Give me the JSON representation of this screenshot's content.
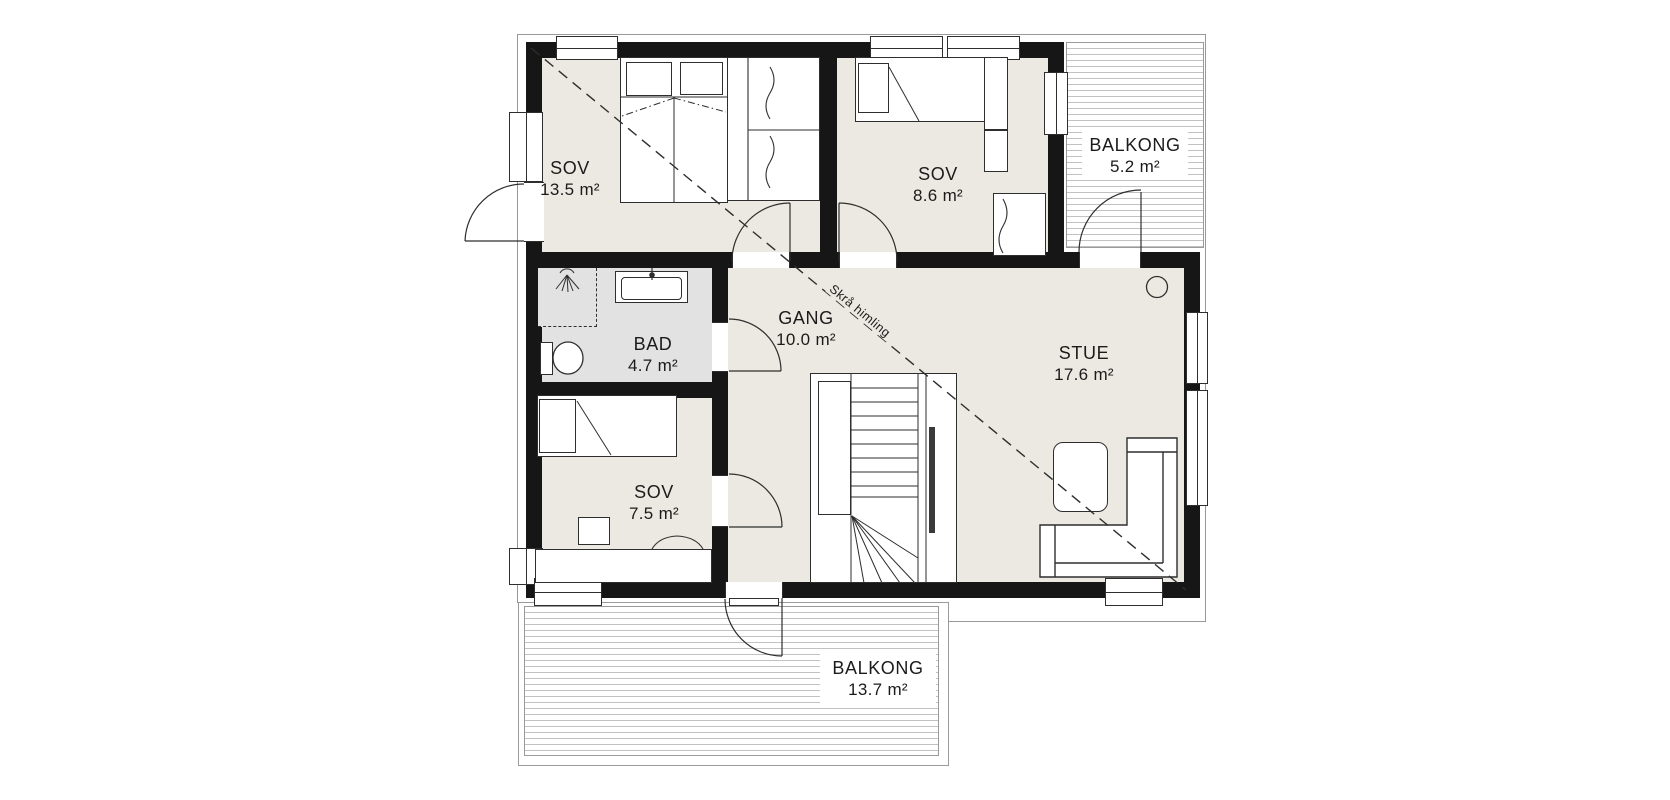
{
  "plan": {
    "title": "floor-plan",
    "rooms": [
      {
        "id": "sov1",
        "name": "SOV",
        "area": "13.5 m²"
      },
      {
        "id": "sov2",
        "name": "SOV",
        "area": "8.6 m²"
      },
      {
        "id": "balkong1",
        "name": "BALKONG",
        "area": "5.2 m²"
      },
      {
        "id": "bad",
        "name": "BAD",
        "area": "4.7 m²"
      },
      {
        "id": "gang",
        "name": "GANG",
        "area": "10.0 m²"
      },
      {
        "id": "stue",
        "name": "STUE",
        "area": "17.6 m²"
      },
      {
        "id": "sov3",
        "name": "SOV",
        "area": "7.5 m²"
      },
      {
        "id": "balkong2",
        "name": "BALKONG",
        "area": "13.7 m²"
      }
    ],
    "annotations": {
      "sloped_ceiling": "Skrå himling"
    },
    "colors": {
      "wall": "#161616",
      "floor": "#ebe9e1",
      "bathroom_floor": "#e2e2e2",
      "deck_line": "#c2c2c2",
      "outline": "#999999",
      "ink": "#1b1b1b"
    }
  }
}
